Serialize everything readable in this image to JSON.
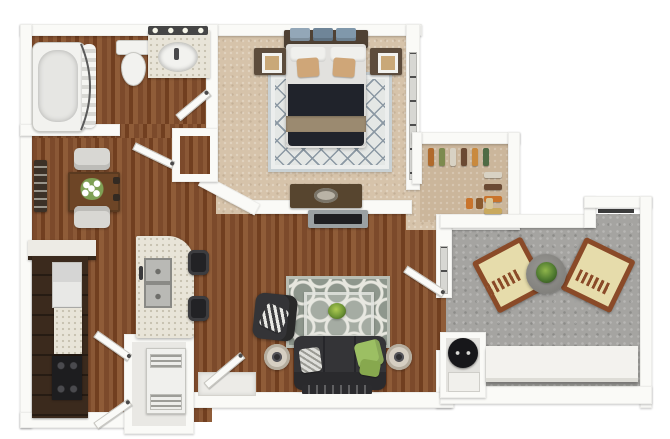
{
  "figure": {
    "kind": "3d-floor-plan-rendering",
    "unit_layout": "one-bedroom one-bath apartment with balcony",
    "visible_text": []
  },
  "colors": {
    "bg": "#ffffff",
    "wall": "#fafaf7",
    "wood_a": "#7c4a2b",
    "wood_b": "#8a5836",
    "wood_c": "#713f20",
    "wood_d": "#8f5c38",
    "carpet": "#d6c3aa",
    "carpet2": "#cbb69b",
    "concrete": "#a5a4a1",
    "marble": "#e8e4d8",
    "rug_bedroom": "#e4e7e5",
    "rug_bedroom_line": "#8b98a3",
    "rug_living": "#8e978d",
    "rug_living_pattern": "#e7e7df",
    "sofa": "#343437",
    "duvet": "#20232b",
    "throw": "#9b8a70",
    "tan_pillow": "#cfa678",
    "green_pillow": "#9cbf63",
    "nightstand": "#5d4c3c",
    "headboard": "#4f4134",
    "dresser": "#57452f",
    "cabinet": "#3b2a1d",
    "stove": "#1d1d1f",
    "chair_wood": "#8a4a28",
    "cushion": "#e6dcab",
    "table_wood": "#6d4526",
    "dining_chair": "#d8d7d3",
    "heater": "#17171a",
    "tv": "#1f1f22"
  },
  "closet": {
    "top_items": [
      "#b06a2c",
      "#7d8a4f",
      "#d8d2c4",
      "#6b4a33",
      "#c98a3e",
      "#4f6b45"
    ],
    "right_items": [
      "#d8d2c4",
      "#6b4a33",
      "#c9742c",
      "#c9a95e"
    ],
    "floor_items": [
      "#c9742c",
      "#8a5a2e",
      "#d8c79a"
    ]
  },
  "bed": {
    "blanket_stack": [
      "#93a7b8",
      "#6f8598",
      "#8098ab"
    ]
  }
}
